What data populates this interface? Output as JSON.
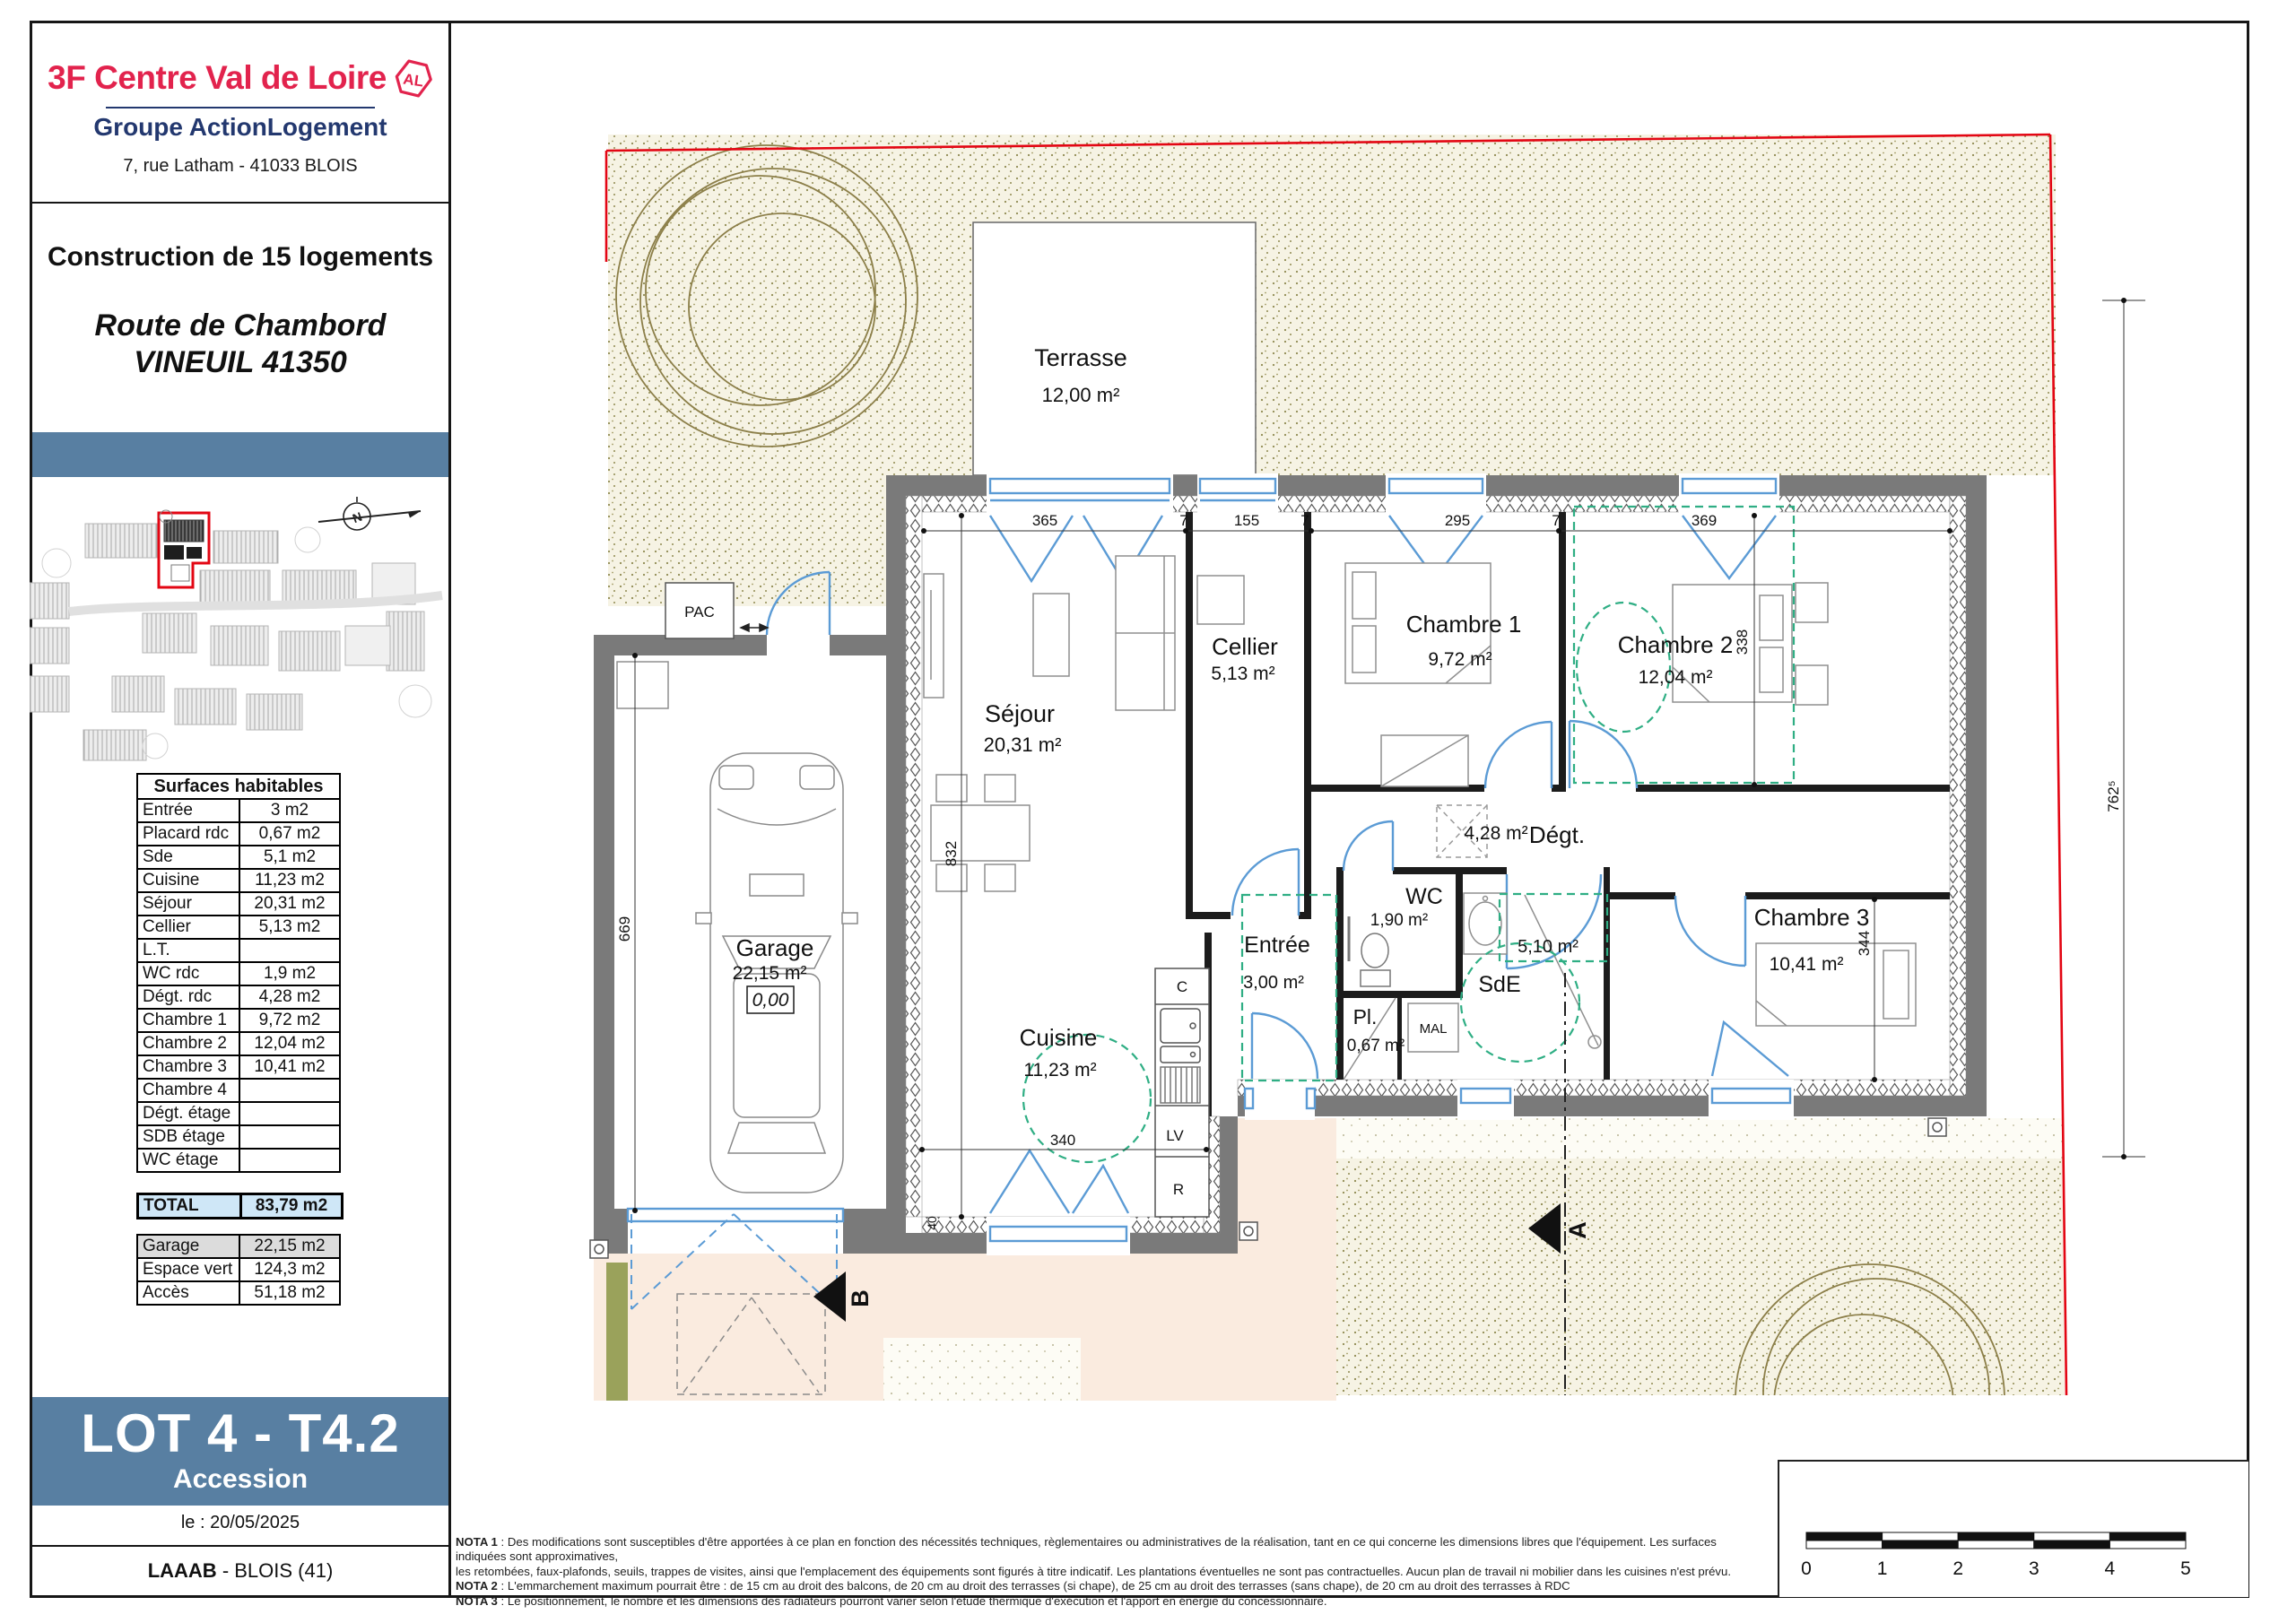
{
  "sidebar": {
    "logo": {
      "brand": "3F Centre Val de Loire",
      "badge": "AL",
      "group": "Groupe ActionLogement",
      "address": "7, rue Latham - 41033 BLOIS"
    },
    "project": {
      "line1": "Construction de 15 logements",
      "line2": "Route de Chambord",
      "line3": "VINEUIL 41350"
    },
    "surfaces": {
      "title": "Surfaces habitables",
      "rows": [
        {
          "label": "Entrée",
          "value": "3 m2"
        },
        {
          "label": "Placard rdc",
          "value": "0,67 m2"
        },
        {
          "label": "Sde",
          "value": "5,1 m2"
        },
        {
          "label": "Cuisine",
          "value": "11,23 m2"
        },
        {
          "label": "Séjour",
          "value": "20,31 m2"
        },
        {
          "label": "Cellier",
          "value": "5,13 m2"
        },
        {
          "label": "L.T.",
          "value": ""
        },
        {
          "label": "WC rdc",
          "value": "1,9 m2"
        },
        {
          "label": "Dégt. rdc",
          "value": "4,28 m2"
        },
        {
          "label": "Chambre 1",
          "value": "9,72 m2"
        },
        {
          "label": "Chambre 2",
          "value": "12,04 m2"
        },
        {
          "label": "Chambre 3",
          "value": "10,41 m2"
        },
        {
          "label": "Chambre 4",
          "value": ""
        },
        {
          "label": "Dégt. étage",
          "value": ""
        },
        {
          "label": "SDB étage",
          "value": ""
        },
        {
          "label": "WC étage",
          "value": ""
        }
      ]
    },
    "total": {
      "label": "TOTAL",
      "value": "83,79 m2"
    },
    "annexes": [
      {
        "label": "Garage",
        "value": "22,15 m2"
      },
      {
        "label": "Espace vert",
        "value": "124,3 m2"
      },
      {
        "label": "Accès",
        "value": "51,18 m2"
      }
    ],
    "lot": {
      "title": "LOT 4 - T4.2",
      "subtitle": "Accession"
    },
    "date": "le : 20/05/2025",
    "firm_bold": "LAAAB",
    "firm_rest": " - BLOIS (41)"
  },
  "plan": {
    "rooms": {
      "terrasse": {
        "name": "Terrasse",
        "area": "12,00 m²"
      },
      "sejour": {
        "name": "Séjour",
        "area": "20,31 m²"
      },
      "cellier": {
        "name": "Cellier",
        "area": "5,13 m²"
      },
      "chambre1": {
        "name": "Chambre 1",
        "area": "9,72 m²"
      },
      "chambre2": {
        "name": "Chambre 2",
        "area": "12,04 m²"
      },
      "chambre3": {
        "name": "Chambre 3",
        "area": "10,41 m²"
      },
      "degt": {
        "name": "Dégt.",
        "area": "4,28 m²"
      },
      "wc": {
        "name": "WC",
        "area": "1,90 m²"
      },
      "entree": {
        "name": "Entrée",
        "area": "3,00 m²"
      },
      "sde": {
        "name": "SdE",
        "area": "5,10 m²"
      },
      "pl": {
        "name": "Pl.",
        "area": "0,67 m²"
      },
      "cuisine": {
        "name": "Cuisine",
        "area": "11,23 m²"
      },
      "garage": {
        "name": "Garage",
        "area": "22,15 m²"
      }
    },
    "labels": {
      "pac": "PAC",
      "mal": "MAL",
      "c": "C",
      "lv": "LV",
      "r": "R",
      "level": "0,00",
      "north": "N"
    },
    "sections": {
      "a": "A",
      "b": "B"
    },
    "dims": {
      "d365": "365",
      "d7": "7",
      "d155": "155",
      "d295": "295",
      "d369": "369",
      "d338": "338",
      "d832": "832",
      "d669": "669",
      "d344": "344",
      "d340": "340",
      "d762": "762⁵",
      "d40": "40"
    }
  },
  "notes": [
    {
      "bold": "NOTA 1",
      "text": " : Des modifications sont susceptibles d'être apportées à ce plan en fonction des nécessités techniques, règlementaires ou administratives de la réalisation, tant en ce qui concerne les dimensions libres que l'équipement. Les surfaces indiquées sont approximatives,"
    },
    {
      "bold": "",
      "text": "les retombées, faux-plafonds, seuils, trappes de visites, ainsi que l'emplacement des équipements sont figurés à titre indicatif. Les plantations éventuelles ne sont pas contractuelles. Aucun plan de travail ni mobilier dans les cuisines n'est prévu."
    },
    {
      "bold": "NOTA 2",
      "text": " : L'emmarchement maximum pourrait être : de 15 cm au droit des balcons, de 20 cm au droit des terrasses (si chape), de 25 cm au droit des terrasses (sans chape), de 20 cm au droit des terrasses à RDC"
    },
    {
      "bold": "NOTA 3",
      "text": " : Le positionnement, le nombre et les dimensions des radiateurs pourront varier selon l'étude thermique d'exécution et l'apport en énergie du concessionnaire."
    }
  ],
  "scale": {
    "ticks": [
      "0",
      "1",
      "2",
      "3",
      "4",
      "5"
    ]
  },
  "colors": {
    "brand_red": "#e2234d",
    "navy": "#23386f",
    "banner_blue": "#587fa2",
    "total_bg": "#cfe7f7",
    "row_gray": "#dcdcdc",
    "wall_gray": "#7a7a7a",
    "window_blue": "#5b9bd5",
    "accessibility_green": "#2fae84",
    "boundary_red": "#e30613"
  }
}
